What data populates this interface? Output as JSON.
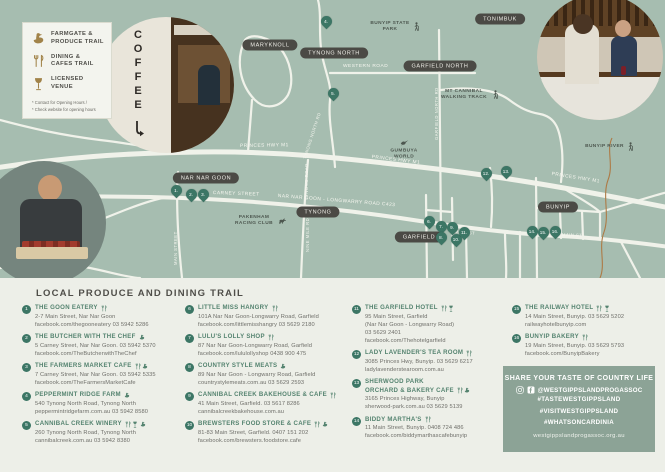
{
  "legend": {
    "items": [
      {
        "icon": "farmgate",
        "line1": "FARMGATE &",
        "line2": "PRODUCE TRAIL"
      },
      {
        "icon": "dining",
        "line1": "DINING &",
        "line2": "CAFES TRAIL"
      },
      {
        "icon": "licensed",
        "line1": "LICENSED",
        "line2": "VENUE"
      }
    ],
    "note1": "* Contact for Opening Hours /",
    "note2": "* Check website for opening hours"
  },
  "map": {
    "towns": {
      "maryknoll": "MARYKNOLL",
      "tynong_north": "TYNONG NORTH",
      "tonimbuk": "TONIMBUK",
      "garfield_north": "GARFIELD NORTH",
      "nar_nar_goon": "NAR NAR GOON",
      "tynong": "TYNONG",
      "garfield": "GARFIELD",
      "bunyip": "BUNYIP"
    },
    "roads": {
      "princes_hwy_1": "PRINCES HWY M1",
      "princes_hwy_2": "PRINCES HWY M1",
      "princes_hwy_3": "PRINCES HWY M1",
      "western_road": "WESTERN ROAD",
      "carney_street": "CARNEY STREET",
      "nng_longwarry": "NAR NAR GOON - LONGWARRY ROAD C423",
      "main_st_garfield": "MAIN ST",
      "main_st_bunyip": "MAIN ST",
      "tynong_north_rd": "TYNONG NORTH RD",
      "garfield_north_rd": "GARFIELD NORTH RD",
      "main_street_nng": "MAIN STREET",
      "tynong_rd": "TYNONG ROAD",
      "nine_mile_rd": "NINE MILE RD"
    },
    "pois": {
      "bunyip_state_park": {
        "label": "BUNYIP STATE PARK",
        "icon": "hiker"
      },
      "mt_cannibal": {
        "label": "MT CANNIBAL WALKING TRACK",
        "icon": "hiker"
      },
      "bunyip_river": {
        "label": "BUNYIP RIVER",
        "icon": "hiker"
      },
      "gumbuya_world": {
        "label": "GUMBUYA WORLD",
        "icon": "bird"
      },
      "pakenham_racing_club": {
        "label": "PAKENHAM RACING CLUB",
        "icon": "horse"
      }
    },
    "markers": [
      "1.",
      "2.",
      "3.",
      "4.",
      "5.",
      "6.",
      "7.",
      "8.",
      "9.",
      "10.",
      "11.",
      "12.",
      "13.",
      "14.",
      "15.",
      "16."
    ]
  },
  "photos": {
    "coffee_sign_text": "COFFEE"
  },
  "listings": {
    "title": "LOCAL PRODUCE AND DINING TRAIL",
    "items": [
      {
        "num": "1",
        "name": "THE GOON EATERY",
        "icons": "dining",
        "lines": [
          "2-7 Main Street, Nar Nar Goon",
          "facebook.com/thegooneatery  03 5942 5286"
        ]
      },
      {
        "num": "2",
        "name": "THE BUTCHER WITH THE CHEF",
        "icons": "farmgate",
        "lines": [
          "5 Carney Street, Nar Nar Goon. 03 5942 5370",
          "facebook.com/TheButcherwithTheChef"
        ]
      },
      {
        "num": "3",
        "name": "THE FARMERS MARKET CAFE",
        "icons": "dining farmgate",
        "lines": [
          "7 Carney Street, Nar Nar Goon. 03 5942 5335",
          "facebook.com/TheFarmersMarketCafe"
        ]
      },
      {
        "num": "4",
        "name": "PEPPERMINT RIDGE FARM",
        "icons": "farmgate",
        "lines": [
          "540 Tynong North Road, Tynong North",
          "peppermintridgefarm.com.au  03 5942 8580"
        ]
      },
      {
        "num": "5",
        "name": "CANNIBAL CREEK WINERY",
        "icons": "dining licensed farmgate",
        "lines": [
          "260 Tynong North Road, Tynong North",
          "cannibalcreek.com.au  03 5942 8380"
        ]
      },
      {
        "num": "6",
        "name": "LITTLE MISS HANGRY",
        "icons": "dining",
        "lines": [
          "101A Nar Nar Goon-Longwarry Road, Garfield",
          "facebook.com/littlemisshangry  03 5629 2180"
        ]
      },
      {
        "num": "7",
        "name": "LULU'S LOLLY SHOP",
        "icons": "dining",
        "lines": [
          "87 Nar Nar Goon-Longwarry Road, Garfield",
          "facebook.com/lululollyshop  0438 900 475"
        ]
      },
      {
        "num": "8",
        "name": "COUNTRY STYLE MEATS",
        "icons": "farmgate",
        "lines": [
          "89 Nar Nar Goon - Longwarry Road, Garfield",
          "countrystylemeats.com.au  03 5629 2593"
        ]
      },
      {
        "num": "9",
        "name": "CANNIBAL CREEK BAKEHOUSE & CAFE",
        "icons": "dining",
        "lines": [
          "41 Main Street, Garfield. 03 5617 8286",
          "cannibalcreekbakehouse.com.au"
        ]
      },
      {
        "num": "10",
        "name": "BREWSTERS FOOD STORE & CAFE",
        "icons": "dining farmgate",
        "lines": [
          "81-83 Main Street, Garfield. 0407 151 202",
          "facebook.com/brewsters.foodstore.cafe"
        ]
      },
      {
        "num": "11",
        "name": "THE GARFIELD HOTEL",
        "icons": "dining licensed",
        "lines": [
          "95 Main Street, Garfield",
          "(Nar Nar Goon - Longwarry Road)",
          "03 5629 2401",
          "facebook.com/Thehotelgarfield"
        ]
      },
      {
        "num": "12",
        "name": "LADY LAVENDER'S TEA ROOM",
        "icons": "dining",
        "lines": [
          "3085 Princes Hwy, Bunyip. 03 5629 6217",
          "ladylavenderstearoom.com.au"
        ]
      },
      {
        "num": "13",
        "name": "SHERWOOD PARK",
        "name2": "ORCHARD & BAKERY CAFE",
        "icons": "dining farmgate",
        "lines": [
          "3165 Princes Highway, Bunyip",
          "sherwood-park.com.au  03 5629 5139"
        ]
      },
      {
        "num": "14",
        "name": "BIDDY MARTHA'S",
        "icons": "dining",
        "lines": [
          "11 Main Street, Bunyip. 0408 724 486",
          "facebook.com/biddymarthascafebunyip"
        ]
      },
      {
        "num": "15",
        "name": "THE RAILWAY HOTEL",
        "icons": "dining licensed",
        "lines": [
          "14 Main Street, Bunyip. 03 5629 5202",
          "railwayhotelbunyip.com"
        ]
      },
      {
        "num": "16",
        "name": "BUNYIP BAKERY",
        "icons": "dining",
        "lines": [
          "19 Main Street, Bunyip. 03 5629 5793",
          "facebook.com/BunyipBakery"
        ]
      }
    ]
  },
  "share": {
    "title": "SHARE YOUR TASTE OF COUNTRY LIFE",
    "icon1": "instagram",
    "icon2": "facebook",
    "handle": "@WESTGIPPSLANDPROGASSOC",
    "tags": [
      "#TASTEWESTGIPPSLAND",
      "#VISITWESTGIPPSLAND",
      "#WHATSONCARDINIA"
    ],
    "website": "westgippslandprogassoc.org.au"
  }
}
